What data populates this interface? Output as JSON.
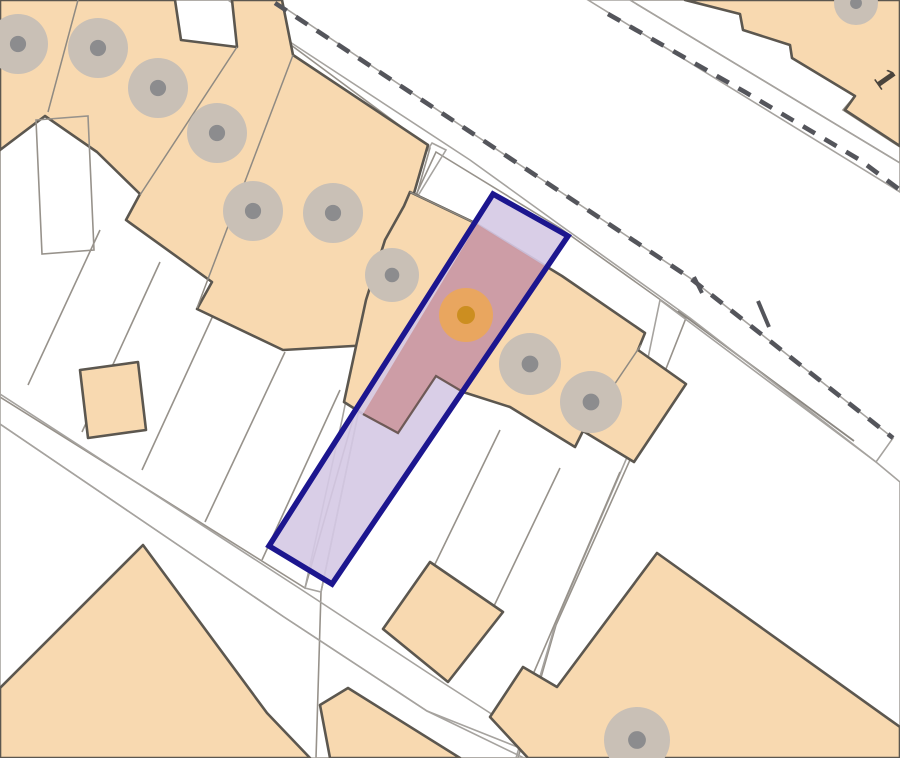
{
  "map": {
    "title": "property-location-plan",
    "house_number_label": "1",
    "marker": {
      "x": 466,
      "y": 315,
      "outer_r": 27,
      "inner_r": 9
    },
    "highlighted_plot": {
      "outline_points": "493,194 568,236 332,584 269,546",
      "building_points": "477,224 548,268 463,392 436,376 398,433 363,414"
    },
    "trees": [
      {
        "x": 18,
        "y": 44,
        "r": 30
      },
      {
        "x": 98,
        "y": 48,
        "r": 30
      },
      {
        "x": 158,
        "y": 88,
        "r": 30
      },
      {
        "x": 217,
        "y": 133,
        "r": 30
      },
      {
        "x": 253,
        "y": 211,
        "r": 30
      },
      {
        "x": 333,
        "y": 213,
        "r": 30
      },
      {
        "x": 392,
        "y": 275,
        "r": 27
      },
      {
        "x": 530,
        "y": 364,
        "r": 31
      },
      {
        "x": 591,
        "y": 402,
        "r": 31
      },
      {
        "x": 856,
        "y": 3,
        "r": 22
      },
      {
        "x": 637,
        "y": 740,
        "r": 33
      }
    ],
    "colors": {
      "road_white": "#ffffff",
      "parcel_ivory": "#f7f5f1",
      "pavement": "#dcd9d5",
      "road_band": "#d8d5d1",
      "lane": "#d4d1ce",
      "gray_area": "#e4e1dd",
      "building_peach": "#f8d9b0",
      "building_outline": "#5c574f",
      "tree_fill": "#c9c0b6",
      "tree_dot": "#8c8c8e",
      "dash_line": "#54555b",
      "plot_lavender": "#d5c9e4",
      "plot_building_salmon": "#cc9aa2",
      "plot_navy": "#1c168f",
      "marker_outer": "#f0a94e",
      "marker_inner": "#cc8e20",
      "label_color": "#4a443c",
      "inner_gray_line": "#8b8781"
    }
  }
}
